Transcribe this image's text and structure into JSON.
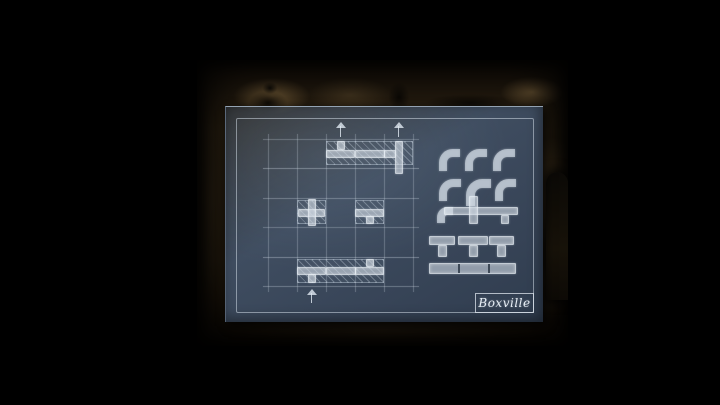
{
  "blueprint": {
    "label": "Boxville",
    "grid": {
      "cols": 5,
      "rows": 5
    },
    "hatched_cells": [
      {
        "col": 3,
        "row": 1,
        "span_cols": 3
      },
      {
        "col": 2,
        "row": 3,
        "span_cols": 1
      },
      {
        "col": 4,
        "row": 3,
        "span_cols": 1
      },
      {
        "col": 2,
        "row": 5,
        "span_cols": 3
      }
    ],
    "pieces": [
      {
        "col": 3,
        "row": 1,
        "type": "tee",
        "dir": "up"
      },
      {
        "col": 4,
        "row": 1,
        "type": "straight",
        "dir": "h"
      },
      {
        "col": 5,
        "row": 1,
        "type": "tee",
        "dir": "left",
        "tall": true
      },
      {
        "col": 2,
        "row": 3,
        "type": "cross"
      },
      {
        "col": 4,
        "row": 3,
        "type": "tee",
        "dir": "down"
      },
      {
        "col": 2,
        "row": 5,
        "type": "tee",
        "dir": "down"
      },
      {
        "col": 3,
        "row": 5,
        "type": "straight",
        "dir": "h"
      },
      {
        "col": 4,
        "row": 5,
        "type": "tee",
        "dir": "up"
      }
    ],
    "arrows": [
      {
        "col": 3,
        "edge": "top"
      },
      {
        "col": 5,
        "edge": "top"
      },
      {
        "col": 2,
        "edge": "bottom"
      }
    ],
    "palette": [
      {
        "row": 1,
        "items": [
          "elbow",
          "elbow",
          "elbow"
        ]
      },
      {
        "row": 2,
        "items": [
          "elbow",
          "elbow-large",
          "elbow"
        ]
      },
      {
        "row": 3,
        "items": [
          "elbow-cross-tee-run"
        ]
      },
      {
        "row": 4,
        "items": [
          "tee-down",
          "tee-down",
          "tee-down"
        ]
      },
      {
        "row": 5,
        "items": [
          "straight-long"
        ]
      }
    ],
    "colors": {
      "paper": "#3e4c5f",
      "chalk": "#dde6ee",
      "wall": "#6b5434"
    }
  }
}
